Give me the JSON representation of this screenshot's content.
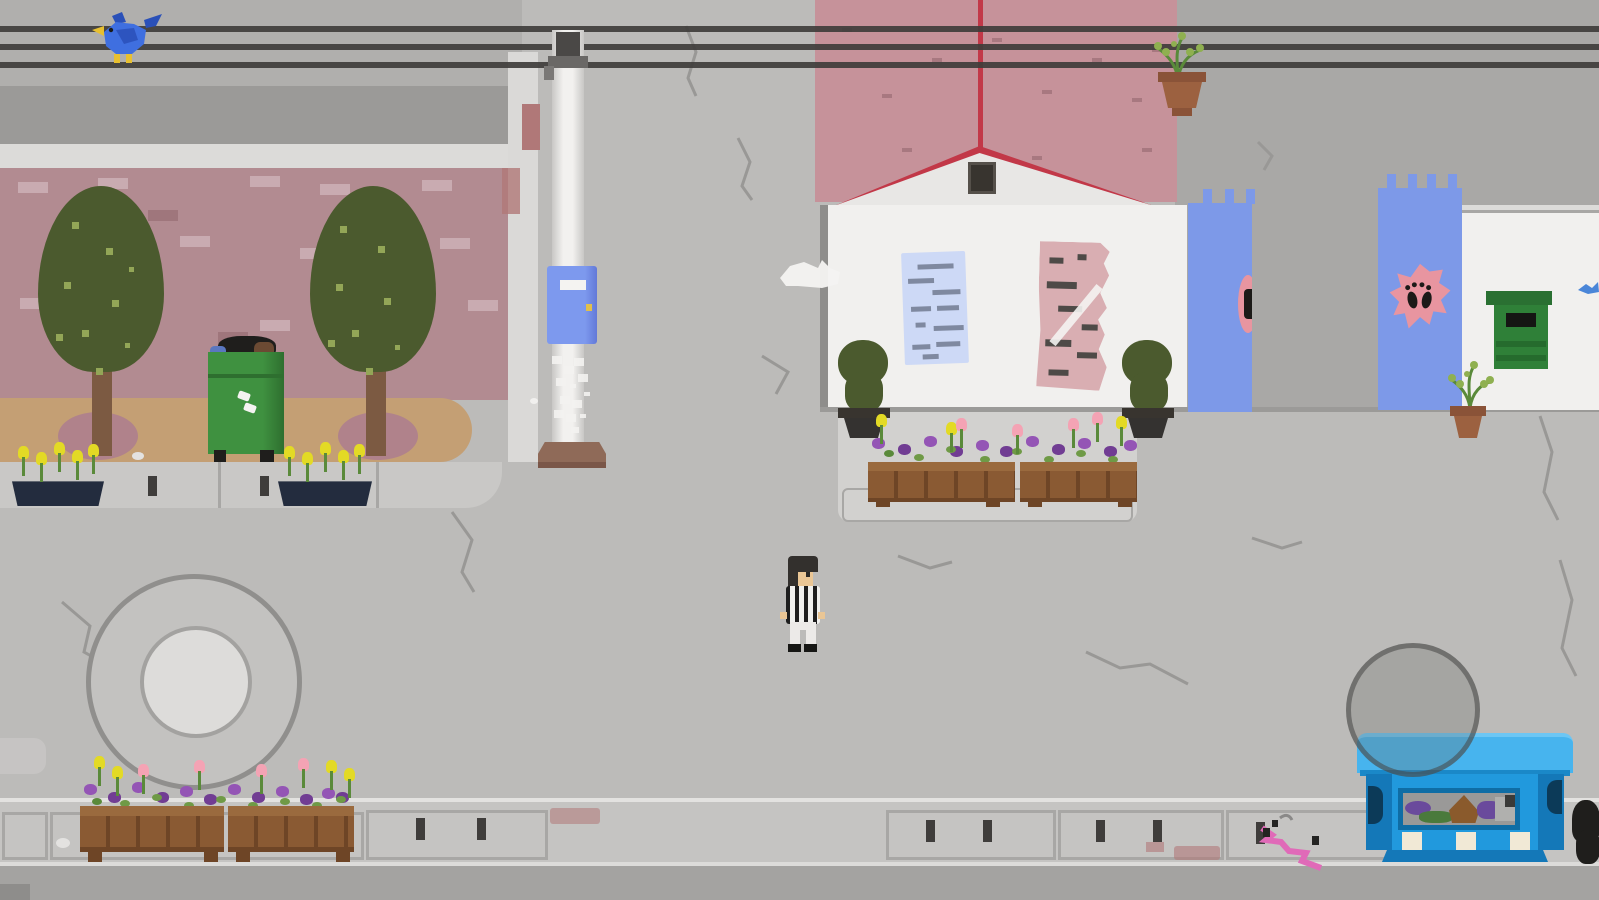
{
  "meta": {
    "description": "Pixel-art side-view street scene from a 2D game. No UI text is visible on screen.",
    "visible_text": []
  },
  "palette": {
    "street": "#bcbbb9",
    "street-top-left": "#b0afad",
    "backdrop-gray": "#a9a8a6",
    "road": "#a4a3a1",
    "road-dark": "#8e8d8b",
    "sidewalk": "#c9c8c6",
    "sidewalk-line": "#a8a7a5",
    "sidewalk-edge": "#e3e2e0",
    "mid-sidewalk": "#d2d1cf",
    "slot-dark": "#3f3d3b",
    "wall-gray": "#9b9a98",
    "cornice": "#dcdbd9",
    "trim-white": "#dad9d7",
    "brick": "#b28b91",
    "brick-light": "#c9abb1",
    "brick-dark": "#9f767c",
    "dirt": "#c49f74",
    "bush": "#b0828b",
    "tree": "#4b5a2e",
    "tree-dot": "#93a657",
    "trunk": "#7c5a42",
    "bin": "#3f9140",
    "bin-dark": "#2e6f2f",
    "trash-black": "#1f1e1c",
    "trash-brown": "#6b4a33",
    "trash-blue": "#5a77c0",
    "trash-navy": "#2c3550",
    "planter-navy": "#232c3e",
    "wood": "#8a5a33",
    "wood-dark": "#6e4526",
    "wood-light": "#9a6a3e",
    "flower-yellow": "#e3da25",
    "flower-purple": "#9455b5",
    "flower-purple-dark": "#713d93",
    "flower-pink": "#f4a3b4",
    "stem": "#5a8a3a",
    "leaf": "#6f9a46",
    "pole": "#f2f1ef",
    "pole-shade": "#c8c7c5",
    "pole-base": "#8f6a58",
    "hardware": "#4a4846",
    "callbox": "#7d99ee",
    "callbox-side": "#6379d8",
    "callbox-key": "#e2c04a",
    "wire": "#3f3d3b",
    "bird": "#3f6fe0",
    "bird-dark": "#2a50b8",
    "bird-yellow": "#e8c030",
    "roof": "#c6929a",
    "roof-mark": "#a87880",
    "roof-red": "#c23848",
    "gable": "#e8e7e5",
    "vent": "#38342f",
    "wall-white": "#f1f0ee",
    "wall-shadow": "#8e8d8b",
    "poster-blue": "#cdd9f6",
    "poster-lines": "#7f89a0",
    "poster-pink": "#d9aeb2",
    "poster-marks": "#4e4a47",
    "banner": "#7d99e8",
    "emblem-pink": "#e895a0",
    "emblem-black": "#1c1a18",
    "box-green": "#2f8038",
    "box-green-dark": "#256b2d",
    "box-cap": "#2a7032",
    "pot": "#9c6140",
    "pot-dark": "#8a5338",
    "fountain-fill": "#c3c2c0",
    "fountain-border": "#908f8d",
    "fountain-inner": "#dddcda",
    "fountain-inner-border": "#a3a2a0",
    "overlay-circle": "#6c6b69",
    "dumpster": "#2199dd",
    "dumpster-lid": "#47b4ee",
    "dumpster-lid-hi": "#6cc6f4",
    "dumpster-dark": "#1478b8",
    "dumpster-frame": "#0f6da5",
    "window-bg": "#9a9998",
    "cream": "#f1e9d6",
    "graffiti-pink": "#e06ab8",
    "graffiti-blue": "#4a86d8",
    "skin": "#eac695",
    "hair": "#33302d",
    "pants": "#eceae8",
    "shirt-light": "#f0f0ee",
    "shirt-dark": "#1e1e1e",
    "stain": "#b07878",
    "crack": "#999896",
    "white": "#f4f3f1"
  },
  "scene": {
    "objects": [
      {
        "name": "power-lines",
        "desc": "three dark overhead wires spanning the screen"
      },
      {
        "name": "blue-bird",
        "desc": "blue bird with yellow beak and feet perched on the wires, top left"
      },
      {
        "name": "left-building",
        "desc": "brick facade with gray upper band and light cornice"
      },
      {
        "name": "trees",
        "count": 2,
        "desc": "dark olive trees with dotted highlights on brown trunks"
      },
      {
        "name": "green-trash-bin",
        "desc": "overflowing green wheelie bin with black, brown and blue garbage"
      },
      {
        "name": "utility-pole",
        "desc": "white pole with crossarm hardware and brown base"
      },
      {
        "name": "blue-call-box",
        "desc": "blue box with white slot and yellow keyhole mounted on the pole"
      },
      {
        "name": "pole-graffiti",
        "desc": "white scribble on pole"
      },
      {
        "name": "pink-roof-house",
        "desc": "dusty-pink roof, red ridge, white gable with dark attic vent"
      },
      {
        "name": "posters",
        "count": 2,
        "desc": "blue notice poster and torn pink poster on white wall"
      },
      {
        "name": "topiary-pots",
        "count": 2,
        "desc": "olive shrubs in dark pots flanking the wall"
      },
      {
        "name": "blue-banners",
        "count": 2,
        "desc": "hanging blue banners with pink emblem / paw marks"
      },
      {
        "name": "right-building",
        "desc": "white wall with green letterbox and potted plant"
      },
      {
        "name": "green-letterbox",
        "desc": "green wall box with dark slot"
      },
      {
        "name": "hanging-plant",
        "desc": "terracotta pot with sprouts below the wires, top right"
      },
      {
        "name": "flower-planters",
        "count": 6,
        "desc": "wooden and navy boxes with yellow, pink and purple flowers"
      },
      {
        "name": "fountain",
        "desc": "large concentric gray circles, lower left"
      },
      {
        "name": "overlay-circle",
        "desc": "translucent gray circle over the dumpster, lower right"
      },
      {
        "name": "blue-dumpster",
        "desc": "bright blue container with window of colorful trash and three cream labels"
      },
      {
        "name": "trash-bags",
        "desc": "black bags at right screen edge"
      },
      {
        "name": "pink-graffiti",
        "desc": "pink squiggle on sidewalk near dumpster"
      },
      {
        "name": "player-character",
        "desc": "pixel person with dark hair, striped shirt, white pants"
      },
      {
        "name": "street-cracks",
        "desc": "thin gray cracks and reddish stains on pavement"
      }
    ]
  }
}
